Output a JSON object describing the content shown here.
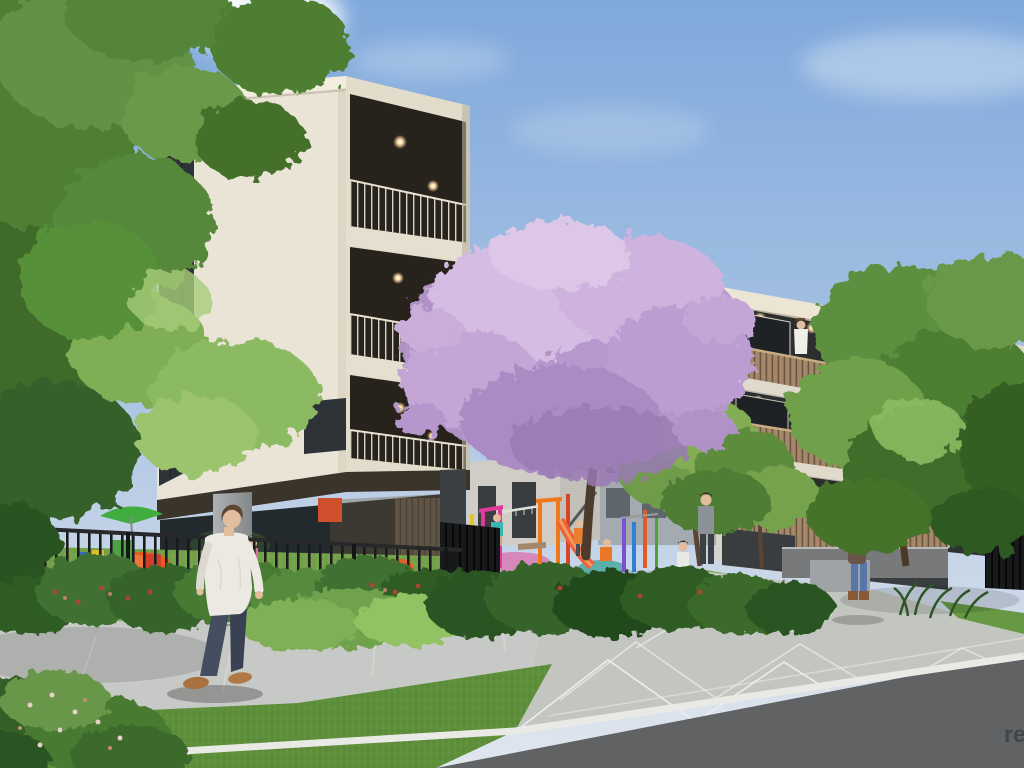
{
  "scene": {
    "kind": "architectural-render",
    "description": "Photoreal CGI render of a residential apartment development: cream 4-storey building at left with dark recessed balconies, grey 3-storey building at right with timber batten balustrades, purple jacaranda tree and colourful childcare playground in the central courtyard, street footpath, paved driveway and road in the foreground.",
    "watermark": {
      "text": "re"
    },
    "palette": {
      "sky_top": "#7fa9dc",
      "sky_horizon": "#e0e6ee",
      "cloud": "#ffffff",
      "left_wall": "#e9e4d6",
      "left_wall_shade": "#ddd6c5",
      "parapet": "#f3edе0",
      "glass_dark": "#2e3338",
      "balcony_recess": "#27221b",
      "downlight": "#ffdca5",
      "railing": "#d9d3c3",
      "right_wall": "#b6b3ac",
      "right_fascia": "#ece5d4",
      "right_recess": "#2b2e2d",
      "timber": "#a5886a",
      "timber_line": "#6b5440",
      "background_building": "#9aa0a4",
      "background_window": "#464c50",
      "concrete_column": "#a0a4a6",
      "jacaranda_light": "#d8c1e6",
      "jacaranda_mid": "#b697cd",
      "jacaranda_deep": "#9c7cb8",
      "foliage_light": "#8cba62",
      "foliage_mid": "#57883a",
      "foliage_dark": "#35602a",
      "grass_yard": "#74a24a",
      "grass_foreground": "#5e8f3a",
      "footpath": "#c7c9c6",
      "paving": "#c3c6c0",
      "paving_joint": "#eceee9",
      "road": "#606263",
      "kerb": "#e9eae6",
      "fence_black": "#1a1c1e",
      "screen_wall": "#17191b",
      "trunk": "#4c3a2c",
      "stone_wall": "#77797b",
      "stone_wall_light": "#9fa3a5",
      "play_magenta": "#e2399b",
      "play_orange": "#f07818",
      "play_blue": "#2f7fd6",
      "play_purple": "#7a4fd0",
      "play_green": "#4da32f",
      "play_yellow": "#e5c32a",
      "play_red": "#d6452a",
      "beanbag_orange": "#e85c20",
      "umbrella_green": "#3fae3f",
      "skin": "#e2bd9e",
      "hair_brown": "#5f4630",
      "shirt_white": "#ebe9e2",
      "jeans": "#41485a",
      "shoe_brown": "#a9713f",
      "watermark_color": "#3c4043"
    },
    "objects": {
      "buildings": [
        {
          "id": "left-apartment-building",
          "storeys": 4,
          "facade": "cream render, dark recessed balconies with fine rail balustrades, glazed childcare ground floor on concrete columns"
        },
        {
          "id": "right-apartment-building",
          "storeys": 3,
          "facade": "grey render, timber batten balcony balustrades, cream fascia, warm downlights"
        },
        {
          "id": "background-building",
          "facade": "grey facade with dark window grid seen through jacaranda"
        }
      ],
      "trees": [
        {
          "id": "jacaranda-tree",
          "state": "full purple bloom, centre of courtyard"
        },
        {
          "id": "left-street-tree",
          "state": "green foliage overhanging top-left foreground"
        },
        {
          "id": "right-street-tree",
          "state": "green, in front of right building corner"
        },
        {
          "id": "courtyard-trees",
          "state": "small green trees between buildings"
        }
      ],
      "people": [
        {
          "id": "pedestrian-man",
          "description": "man in white shirt, dark jeans and brown shoes walking along the footpath"
        },
        {
          "id": "woman-with-child",
          "description": "woman carrying a toddler in pink beside the right building driveway"
        },
        {
          "id": "balcony-resident",
          "description": "person standing at the top-floor balcony of the right building"
        },
        {
          "id": "adult-in-garden",
          "description": "adult standing among courtyard plants"
        },
        {
          "id": "children",
          "description": "several children playing on the equipment, lawn and path"
        }
      ],
      "playground": {
        "equipment_colors": [
          "magenta",
          "orange",
          "red",
          "purple",
          "blue",
          "green",
          "yellow"
        ],
        "features": [
          "climbing frames",
          "monkey bars",
          "slide",
          "soft-fall mats",
          "green shade umbrella",
          "orange bean bags",
          "colourful cubby boxes",
          "black picket fence"
        ]
      },
      "ground": {
        "features": [
          "concrete footpath",
          "chevron paved driveway",
          "lawn verge",
          "native garden shrubs with red flowers",
          "asphalt road",
          "white kerb line",
          "stone planter walls",
          "timber privacy screen",
          "black steel fences"
        ]
      }
    }
  }
}
